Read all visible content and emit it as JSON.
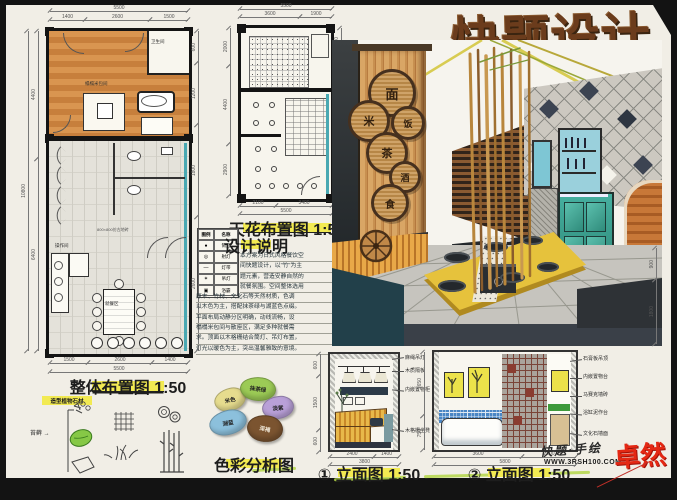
{
  "title": "快题设计",
  "plan1": {
    "caption": "整体布置图 1:50",
    "tile_note": "800×800仿古地砖",
    "labels": [
      "榻榻米包间",
      "卫生间",
      "操作间",
      "就餐区"
    ],
    "dims": {
      "top_total": "5500",
      "top1": "1400",
      "top2": "2600",
      "top3": "1500",
      "left_total": "10800",
      "left1": "4400",
      "left2": "6400",
      "right1": "600",
      "right2": "1200",
      "right3": "1800",
      "right4": "2600",
      "bot1": "1500",
      "bot2": "2600",
      "bot3": "1400",
      "bot_total": "5500"
    }
  },
  "plan2": {
    "caption": "天花布置图 1:50",
    "dims": {
      "top_total": "5500",
      "top1": "3600",
      "top2": "1900",
      "left1": "2000",
      "left2": "4400",
      "left3": "2900",
      "right1": "1200",
      "right2": "3440",
      "right3": "1600",
      "bot1": "2100",
      "bot2": "3400",
      "bot_total": "5500"
    }
  },
  "legend": {
    "headers": [
      "图例",
      "名称"
    ],
    "rows": [
      {
        "sym": "●",
        "name": "筒灯"
      },
      {
        "sym": "◎",
        "name": "射灯"
      },
      {
        "sym": "—",
        "name": "灯带"
      },
      {
        "sym": "✶",
        "name": "吊灯"
      },
      {
        "sym": "▣",
        "name": "浴霸"
      }
    ]
  },
  "notes": {
    "heading": "设计说明",
    "lines": [
      "本方案为日式风格餐饮空",
      "间快题设计，以\"竹\"为主",
      "题元素，营造安静自然的",
      "就餐氛围。空间整体选用",
      "原木、竹材、文化石等天然材质，色调",
      "以木色为主，搭配抹茶绿与湖蓝色点缀。",
      "平面布局动静分区明确，动线流畅，设",
      "榻榻米包间与散座区，满足多种就餐需",
      "求。顶面以木格栅结合筒灯、吊灯布置，",
      "灯光以暖色为主，突出温馨雅致的意境。"
    ]
  },
  "palette": {
    "caption": "色彩分析图",
    "swatches": [
      {
        "label": "米色",
        "color": "#e6dc8e"
      },
      {
        "label": "抹茶绿",
        "color": "#9ccb56"
      },
      {
        "label": "淡紫",
        "color": "#b9a0d8"
      },
      {
        "label": "湖蓝",
        "color": "#8cc0dc"
      },
      {
        "label": "深褐",
        "color": "#7b5430"
      }
    ]
  },
  "sketches": {
    "label": "造型植物石材",
    "note": "苔藓 →"
  },
  "trays": [
    "面",
    "米",
    "饭",
    "茶",
    "酒",
    "食"
  ],
  "elev": [
    {
      "caption": "① 立面图 1:50",
      "annotations": [
        "麻绳吊灯",
        "木质隔板",
        "内嵌置物柜",
        "木格栅坐凳"
      ],
      "dims": {
        "left1": "600",
        "left2": "1500",
        "left3": "600",
        "bot1": "2400",
        "bot2": "1400",
        "bot_total": "3800"
      }
    },
    {
      "caption": "② 立面图 1:50",
      "annotations": [
        "石膏板吊顶",
        "内嵌置物台",
        "马赛克墙砖",
        "浴缸泥作台",
        "文化石墙面"
      ],
      "dims": {
        "left1": "1650",
        "left2": "750",
        "bot1": "3600",
        "bot2": "2200",
        "bot_total": "5800"
      }
    }
  ],
  "side_dim": {
    "d1": "900",
    "d2": "1800"
  },
  "watermark": {
    "line1": "快题·手绘",
    "line2": "WWW.3RSH100.COM",
    "logo": "卓然"
  }
}
